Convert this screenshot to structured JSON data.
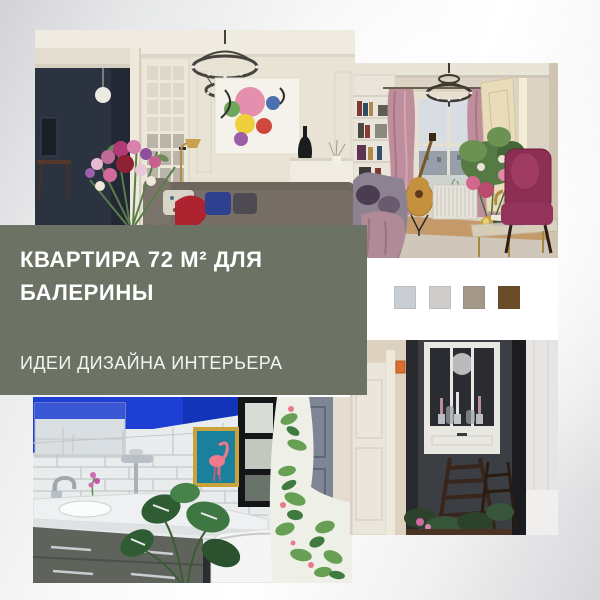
{
  "canvas": {
    "width": 600,
    "height": 600
  },
  "band": {
    "title_line1": "КВАРТИРА 72 М² ДЛЯ",
    "title_line2": "БАЛЕРИНЫ",
    "subtitle": "ИДЕИ ДИЗАЙНА ИНТЕРЬЕРА",
    "bg": "#6c7264",
    "text_color": "#ffffff"
  },
  "palette_card": {
    "bg": "#ffffff",
    "swatches": [
      {
        "name": "light-blue-gray",
        "hex": "#c9ced3"
      },
      {
        "name": "light-gray",
        "hex": "#cecdcb"
      },
      {
        "name": "taupe",
        "hex": "#a3988a"
      },
      {
        "name": "brown",
        "hex": "#6b4c28"
      }
    ]
  },
  "photos": [
    {
      "name": "living-room-chandelier-photo"
    },
    {
      "name": "lounge-pink-curtains-photo"
    },
    {
      "name": "bathroom-blue-flamingo-photo"
    },
    {
      "name": "hallway-dark-dining-photo"
    }
  ]
}
